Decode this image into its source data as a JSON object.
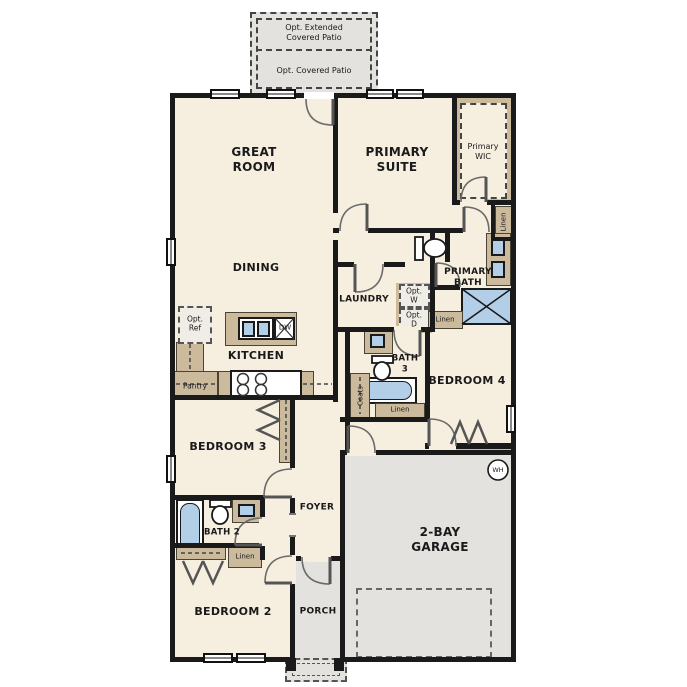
{
  "labels": {
    "opt_extended_patio": "Opt. Extended\nCovered Patio",
    "opt_covered_patio": "Opt. Covered Patio",
    "great_room": "GREAT\nROOM",
    "primary_suite": "PRIMARY\nSUITE",
    "primary_wic": "Primary\nWIC",
    "linen_wic": "Linen",
    "dining": "DINING",
    "laundry": "LAUNDRY",
    "opt_washer": "Opt.\nW",
    "opt_dryer": "Opt.\nD",
    "primary_bath": "PRIMARY\nBATH",
    "linen_bath_hall": "Linen",
    "opt_ref": "Opt.\nRef",
    "kitchen": "KITCHEN",
    "dishwasher": "DW",
    "pantry": "Pantry",
    "bath3": "BATH\n3",
    "coats": "Coats",
    "linen_bath3": "Linen",
    "bedroom4": "BEDROOM 4",
    "bedroom3": "BEDROOM 3",
    "foyer": "FOYER",
    "bath2": "BATH 2",
    "linen_bath2": "Linen",
    "bedroom2": "BEDROOM 2",
    "porch": "PORCH",
    "garage": "2-BAY\nGARAGE",
    "water_heater": "WH"
  },
  "colors": {
    "wall": "#1a1a1a",
    "floor": "#f6efe0",
    "concrete": "#e3e2df",
    "cabinet": "#cbba9b",
    "fixture": "#b3cfe8"
  }
}
